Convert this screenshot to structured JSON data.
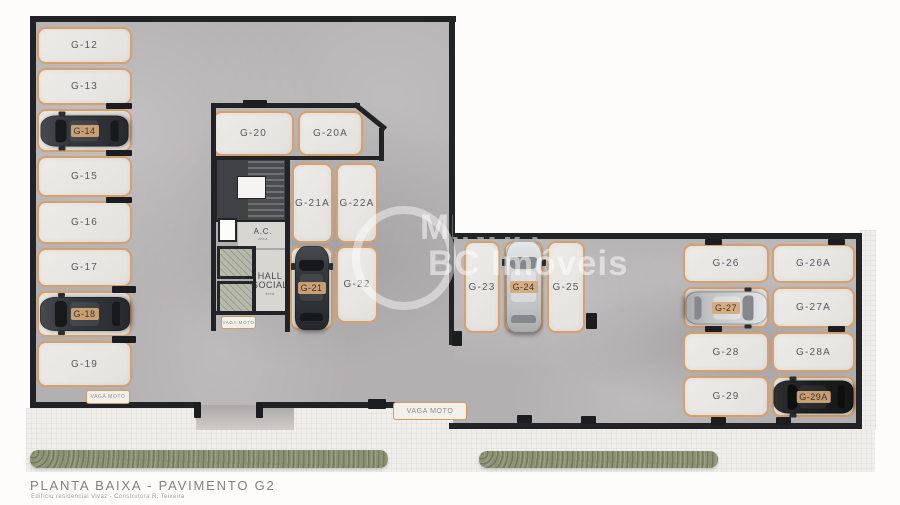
{
  "meta": {
    "title": "PLANTA BAIXA - PAVIMENTO G2",
    "subtitle": "Edifício residencial Vivaz - Construtora R. Teixeira"
  },
  "watermark": {
    "line1": "MINHA",
    "line2": "BC Imóveis"
  },
  "labels": {
    "vaga_moto": "VAGA MOTO",
    "ac": "A.C.",
    "ac_area": "área",
    "hall_line1": "HALL",
    "hall_line2": "SOCIAL",
    "hall_area": "área"
  },
  "colors": {
    "wall": "#222326",
    "floor": "#b3b0b1",
    "space_fill": "#e9e7e3",
    "space_border": "#d79f6c",
    "hedge": "#8d9377",
    "badge": "#d5a777"
  },
  "parking_spaces": [
    {
      "label": "G-12",
      "x": 37,
      "y": 27,
      "w": 95,
      "h": 37
    },
    {
      "label": "G-13",
      "x": 37,
      "y": 68,
      "w": 95,
      "h": 37
    },
    {
      "label": "G-14",
      "x": 37,
      "y": 109,
      "w": 95,
      "h": 43,
      "car": "dark",
      "dir": "left",
      "len": 88,
      "wid": 31
    },
    {
      "label": "G-15",
      "x": 37,
      "y": 156,
      "w": 95,
      "h": 41
    },
    {
      "label": "G-16",
      "x": 37,
      "y": 201,
      "w": 95,
      "h": 43
    },
    {
      "label": "G-17",
      "x": 37,
      "y": 248,
      "w": 95,
      "h": 39
    },
    {
      "label": "G-18",
      "x": 37,
      "y": 291,
      "w": 95,
      "h": 46,
      "car": "dark",
      "dir": "left",
      "len": 90,
      "wid": 34
    },
    {
      "label": "G-19",
      "x": 37,
      "y": 341,
      "w": 95,
      "h": 46
    },
    {
      "label": "G-20",
      "x": 213,
      "y": 111,
      "w": 81,
      "h": 45
    },
    {
      "label": "G-20A",
      "x": 298,
      "y": 111,
      "w": 65,
      "h": 45
    },
    {
      "label": "G-21A",
      "x": 292,
      "y": 163,
      "w": 41,
      "h": 80
    },
    {
      "label": "G-22A",
      "x": 336,
      "y": 163,
      "w": 42,
      "h": 80
    },
    {
      "label": "G-21",
      "x": 290,
      "y": 246,
      "w": 43,
      "h": 84,
      "car": "dark",
      "dir": "up",
      "len": 84,
      "wid": 34
    },
    {
      "label": "G-22",
      "x": 336,
      "y": 246,
      "w": 42,
      "h": 77
    },
    {
      "label": "G-23",
      "x": 464,
      "y": 241,
      "w": 36,
      "h": 92
    },
    {
      "label": "G-24",
      "x": 504,
      "y": 241,
      "w": 39,
      "h": 92,
      "car": "silver",
      "dir": "up",
      "len": 92,
      "wid": 36
    },
    {
      "label": "G-25",
      "x": 547,
      "y": 241,
      "w": 38,
      "h": 92
    },
    {
      "label": "G-26",
      "x": 683,
      "y": 244,
      "w": 86,
      "h": 39
    },
    {
      "label": "G-26A",
      "x": 772,
      "y": 244,
      "w": 83,
      "h": 39
    },
    {
      "label": "G-27",
      "x": 683,
      "y": 287,
      "w": 86,
      "h": 41,
      "car": "silver",
      "dir": "right",
      "len": 82,
      "wid": 33
    },
    {
      "label": "G-27A",
      "x": 772,
      "y": 287,
      "w": 83,
      "h": 41
    },
    {
      "label": "G-28",
      "x": 683,
      "y": 332,
      "w": 86,
      "h": 40
    },
    {
      "label": "G-28A",
      "x": 772,
      "y": 332,
      "w": 83,
      "h": 40
    },
    {
      "label": "G-29",
      "x": 683,
      "y": 376,
      "w": 86,
      "h": 41
    },
    {
      "label": "G-29A",
      "x": 772,
      "y": 376,
      "w": 83,
      "h": 41,
      "car": "black",
      "dir": "left",
      "len": 80,
      "wid": 33
    }
  ],
  "moto_badges": [
    {
      "x": 86,
      "y": 390,
      "w": 42,
      "h": 12,
      "fs": 5
    },
    {
      "x": 221,
      "y": 316,
      "w": 33,
      "h": 11,
      "fs": 4.5
    },
    {
      "x": 393,
      "y": 402,
      "w": 72,
      "h": 16,
      "fs": 7
    }
  ]
}
